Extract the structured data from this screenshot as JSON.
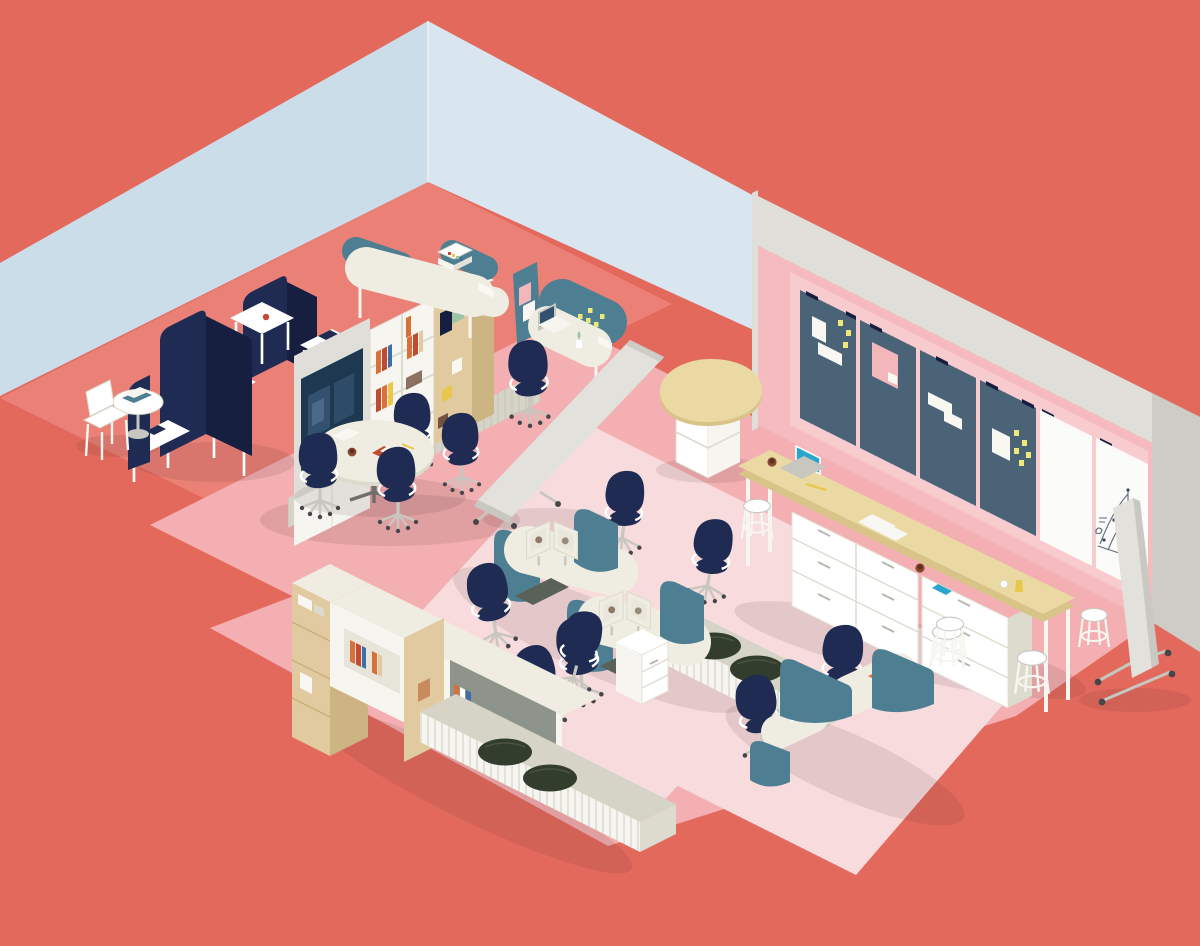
{
  "scene": {
    "title": "Isometric illustration of an open-plan office with coral walls and floors",
    "labels": {
      "walls": "light blue corner walls and pink display wall",
      "bulletin_wall": "wall-mounted slate pin boards with papers and sticky notes",
      "whiteboard_wall": "wall-mounted whiteboards with hand-drawn chart sketch",
      "lounge": "navy privacy booths with tables, round table and white chair",
      "media_wall": "media storage wall with TV, bookshelves and wooden lockers",
      "focus_desks": "curved desks with teal privacy panels, laptop and printer",
      "meeting_table": "oval meeting table with task chairs",
      "work_pods": "monitor work pods with teal screens and navy task chairs",
      "storage_run": "low storage run with books, suitcases and olive poufs",
      "corner_desks": "corner desks wrapped in teal privacy panels",
      "standing_counter": "long standing counter with drawers, stools, laptop and coffee",
      "kidney_table": "kidney-shaped high table on white shelf base",
      "mobile_board": "mobile whiteboard on casters",
      "leaning_divider": "freestanding divider screen on casters"
    }
  },
  "palette": {
    "coral": "#E4695D",
    "coralLight": "#EA8076",
    "blueWallLeft": "#CBDDE9",
    "blueWallRight": "#D9E6EF",
    "roseFloor": "#F3AFB2",
    "rugPink": "#F8DBDC",
    "pinkWall": "#F5BBBF",
    "pinkWallLight": "#F8CBCE",
    "wallGray": "#DFDED8",
    "wallGrayDark": "#CDCCC6",
    "slateBoard": "#4A6377",
    "whiteBoard": "#FBFBF9",
    "navy": "#1F2B52",
    "navyDark": "#161F40",
    "teal": "#4E7E92",
    "tealDark": "#3F6A7D",
    "cream": "#EFEDE2",
    "creamDark": "#DDDBCE",
    "slatGray": "#D6D4C6",
    "slatLine": "#C3C1B2",
    "wood": "#E1CA9F",
    "woodDark": "#CDB483",
    "counterTop": "#EBD9A4",
    "counterEdge": "#D8C489",
    "white": "#FFFFFF",
    "offWhite": "#F6F5F0",
    "silver": "#C7C6BF",
    "olive": "#333D2D",
    "cushion": "#5A6158",
    "screenNavy": "#1D3850",
    "screenBlue": "#31516E",
    "laptopTeal": "#2BA6CB",
    "sticky": "#EDE878",
    "paper": "#F8F7F2",
    "bookOrange": "#D9703A",
    "bookRed": "#C04A32",
    "bookBlue": "#3E6EA5",
    "brown": "#73513D",
    "mugBrown": "#8A4A32",
    "yellow": "#E7C84A",
    "green": "#9CC4A7",
    "shadow": "rgba(60,25,25,0.10)"
  }
}
